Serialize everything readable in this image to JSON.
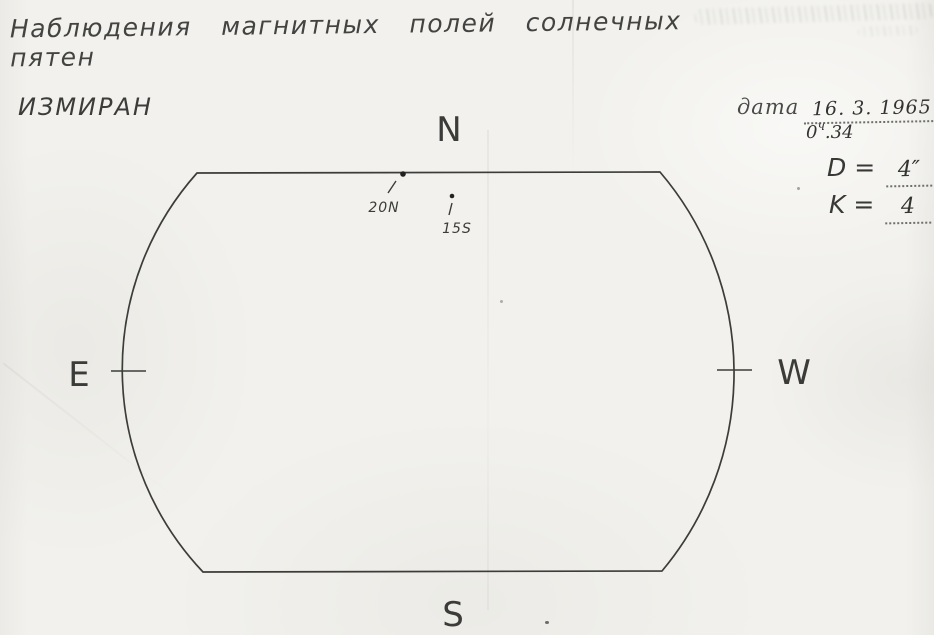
{
  "sheet": {
    "title": "Наблюдения  магнитных  полей  солнечных  пятен",
    "institute": "ИЗМИРАН"
  },
  "observation": {
    "date_label": "дата",
    "date_value": "16. 3. 1965",
    "time": {
      "hours": "0",
      "unit": "ч",
      "minutes": ".34"
    },
    "d_label": "D =",
    "d_value": "4″",
    "k_label": "K =",
    "k_value": "4"
  },
  "disk": {
    "north_label": "N",
    "south_label": "S",
    "east_label": "E",
    "west_label": "W",
    "sunspots": [
      {
        "label": "20N"
      },
      {
        "label": "15S"
      }
    ]
  }
}
